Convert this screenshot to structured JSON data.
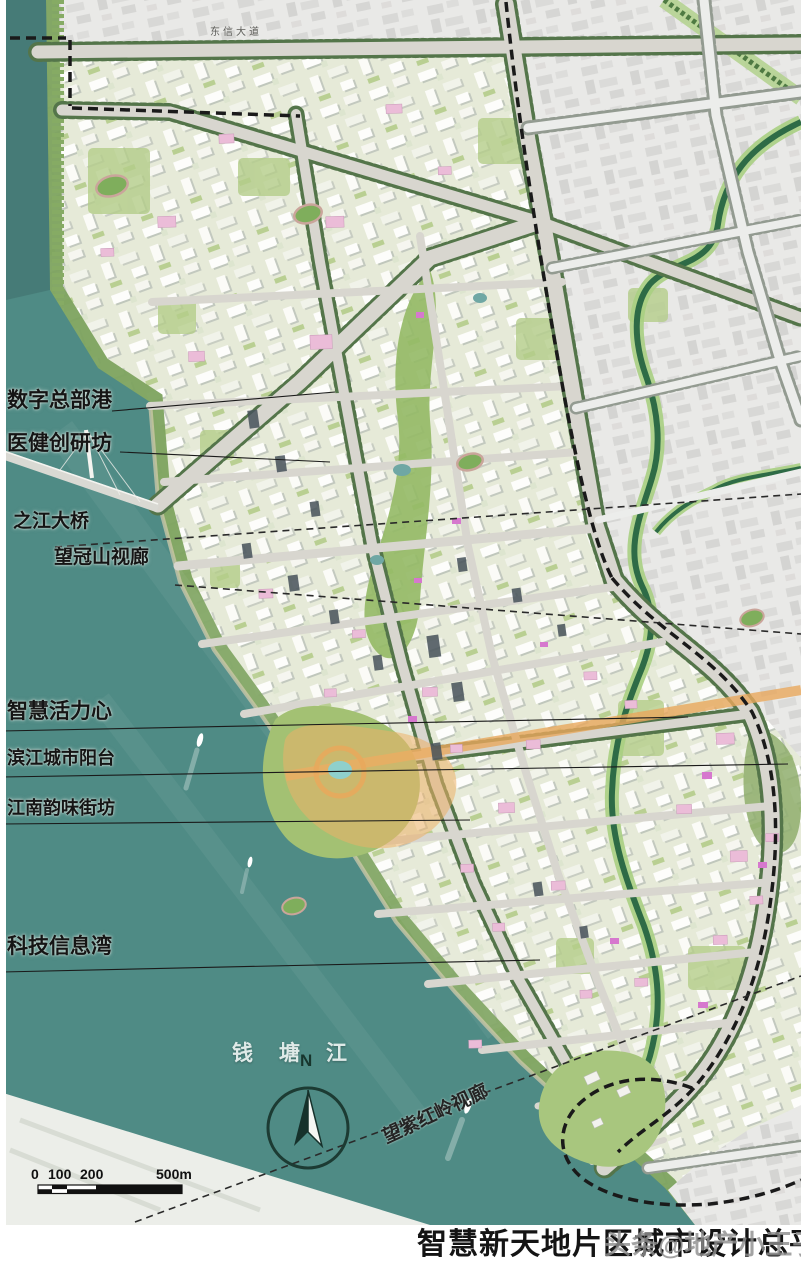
{
  "labels": {
    "district": [
      "数字总部港",
      "医健创研坊",
      "之江大桥",
      "望冠山视廊",
      "智慧活力心",
      "滨江城市阳台",
      "江南韵味街坊",
      "科技信息湾"
    ],
    "river": "钱塘江",
    "corridor_bottom": "望紫红岭视廊",
    "road_top": "东信大道",
    "compass": "N",
    "scale_ticks": [
      "0",
      "100",
      "200",
      "500m"
    ]
  },
  "footer": {
    "title": "智慧新天地片区城市设计总平面图",
    "watermark": "头条@地产小王子"
  },
  "colors": {
    "water": "#4f8b85",
    "planning_land": "#e6ead8",
    "existing_city": "#e9e9e7",
    "canal_green": "#2e6b46",
    "orange_axis": "#e9a85c",
    "boundary_dash": "#1a1a1a",
    "pink_building": "#ebbcd8"
  }
}
